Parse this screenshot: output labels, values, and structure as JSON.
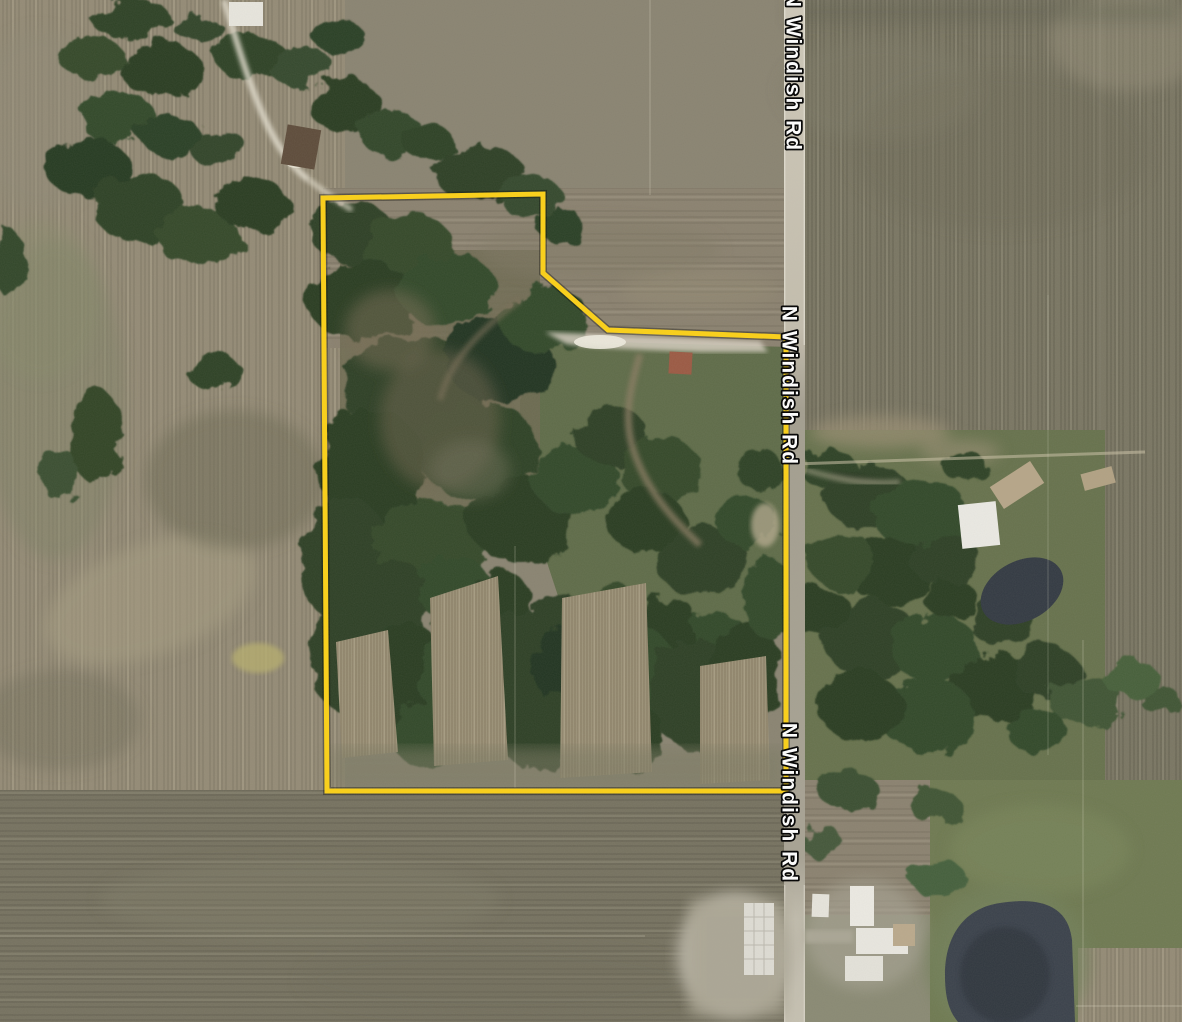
{
  "map": {
    "view_type": "satellite-imagery",
    "road": {
      "name": "N Windish Rd",
      "label_count": 3,
      "label_text_color": "#ffffff",
      "label_outline_color": "#000000",
      "surface_color": "#b3ad9e"
    },
    "parcel": {
      "boundary_color": "#fcd116",
      "boundary_shadow_color": "rgba(0,0,0,0.35)",
      "stroke_width": 5,
      "points": "323,198 543,194 543,273 608,330 786,337 786,791 327,791"
    },
    "features": {
      "woodland_color": "#2d4026",
      "meadow_color": "#5f6c49",
      "field_tan_color": "#948b76",
      "field_olive_color": "#7a7663",
      "large_pond_color": "#3a414b",
      "small_pond_color": "#333a43",
      "farmyard_color": "#b4afa0",
      "building_white_color": "#e9e7e0",
      "building_barn_color": "#5e4c3b",
      "building_red_color": "#9c5a44"
    }
  }
}
